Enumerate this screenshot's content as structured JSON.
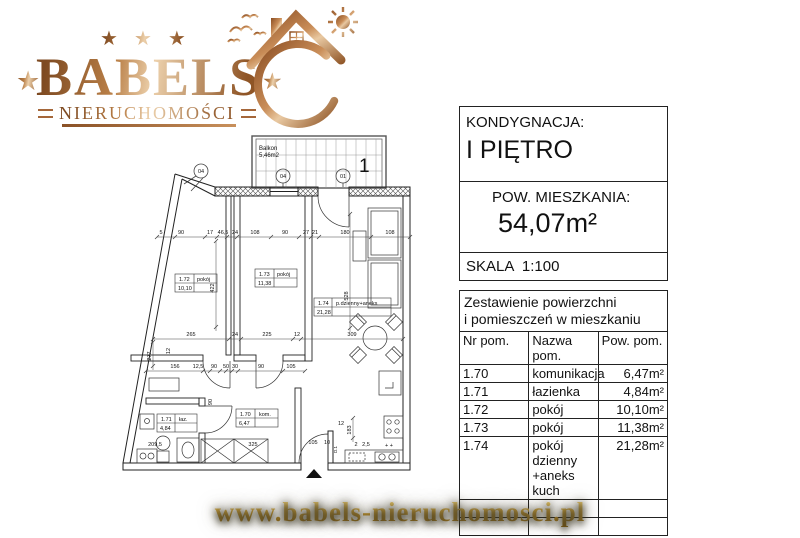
{
  "logo": {
    "brand": "BABELS",
    "subtitle": "NIERUCHOMOŚCI",
    "star": "★",
    "icon": "house-sun-birds-crescent"
  },
  "panel": {
    "floor_label": "KONDYGNACJA:",
    "floor_value": "I PIĘTRO",
    "area_label": "POW. MIESZKANIA:",
    "area_value": "54,07m²",
    "scale_label": "SKALA  1:100",
    "table": {
      "title_line1": "Zestawienie powierzchni",
      "title_line2": "i pomieszczeń w mieszkaniu",
      "headers": [
        "Nr pom.",
        "Nazwa pom.",
        "Pow. pom."
      ],
      "rows": [
        {
          "nr": "1.70",
          "name": "komunikacja",
          "area": "6,47m²"
        },
        {
          "nr": "1.71",
          "name": "łazienka",
          "area": "4,84m²"
        },
        {
          "nr": "1.72",
          "name": "pokój",
          "area": "10,10m²"
        },
        {
          "nr": "1.73",
          "name": "pokój",
          "area": "11,38m²"
        },
        {
          "nr": "1.74",
          "name": "pokój dzienny +aneks kuch",
          "area": "21,28m²"
        }
      ]
    }
  },
  "footer": {
    "url": "www.babels-nieruchomosci.pl"
  },
  "colors": {
    "copper": "#b97f47",
    "gold": "#d9a93c",
    "plan_line": "#222222"
  },
  "plan": {
    "balcony_name": "Balkon",
    "balcony_area": "5,46m2",
    "labels": [
      {
        "t": "Balkon",
        "x": 146,
        "y": 24,
        "s": 6
      },
      {
        "t": "5,46m2",
        "x": 146,
        "y": 31,
        "s": 6
      },
      {
        "t": "04",
        "x": 88,
        "y": 47,
        "s": 5.5,
        "a": "middle"
      },
      {
        "t": "04",
        "x": 170,
        "y": 52,
        "s": 5.5,
        "a": "middle"
      },
      {
        "t": "01",
        "x": 230,
        "y": 52,
        "s": 5.5,
        "a": "middle"
      },
      {
        "t": "1",
        "x": 246,
        "y": 46,
        "s": 19
      },
      {
        "t": "1.72",
        "x": 66,
        "y": 155
      },
      {
        "t": "pokój",
        "x": 84,
        "y": 155
      },
      {
        "t": "10,10",
        "x": 65,
        "y": 164
      },
      {
        "t": "1.73",
        "x": 146,
        "y": 150
      },
      {
        "t": "pokój",
        "x": 164,
        "y": 150
      },
      {
        "t": "11,38",
        "x": 145,
        "y": 159
      },
      {
        "t": "1.74",
        "x": 205,
        "y": 179
      },
      {
        "t": "p.dzienny+aneks",
        "x": 223,
        "y": 179
      },
      {
        "t": "21,28",
        "x": 204,
        "y": 188
      },
      {
        "t": "1.70",
        "x": 127,
        "y": 290
      },
      {
        "t": "kom.",
        "x": 146,
        "y": 290
      },
      {
        "t": "6,47",
        "x": 126,
        "y": 299
      },
      {
        "t": "1.71",
        "x": 48,
        "y": 295
      },
      {
        "t": "łaz.",
        "x": 66,
        "y": 295
      },
      {
        "t": "4,84",
        "x": 47,
        "y": 304
      },
      {
        "t": "5",
        "x": 48,
        "y": 108,
        "a": "middle"
      },
      {
        "t": "90",
        "x": 68,
        "y": 108,
        "a": "middle"
      },
      {
        "t": "17",
        "x": 97,
        "y": 108,
        "a": "middle"
      },
      {
        "t": "46,5",
        "x": 110,
        "y": 108,
        "a": "middle"
      },
      {
        "t": "24",
        "x": 122,
        "y": 108,
        "a": "middle"
      },
      {
        "t": "108",
        "x": 142,
        "y": 108,
        "a": "middle"
      },
      {
        "t": "90",
        "x": 172,
        "y": 108,
        "a": "middle"
      },
      {
        "t": "27",
        "x": 193,
        "y": 108,
        "a": "middle"
      },
      {
        "t": "21",
        "x": 202,
        "y": 108,
        "a": "middle"
      },
      {
        "t": "180",
        "x": 232,
        "y": 108,
        "a": "middle"
      },
      {
        "t": "108",
        "x": 277,
        "y": 108,
        "a": "middle"
      },
      {
        "t": "265",
        "x": 78,
        "y": 210,
        "a": "middle"
      },
      {
        "t": "24",
        "x": 122,
        "y": 210,
        "a": "middle"
      },
      {
        "t": "225",
        "x": 154,
        "y": 210,
        "a": "middle"
      },
      {
        "t": "12",
        "x": 184,
        "y": 210,
        "a": "middle"
      },
      {
        "t": "309",
        "x": 239,
        "y": 210,
        "a": "middle"
      },
      {
        "t": "156",
        "x": 62,
        "y": 242,
        "a": "middle"
      },
      {
        "t": "12,5",
        "x": 85,
        "y": 242,
        "a": "middle"
      },
      {
        "t": "90",
        "x": 101,
        "y": 242,
        "a": "middle"
      },
      {
        "t": "50",
        "x": 113,
        "y": 242,
        "a": "middle"
      },
      {
        "t": "30",
        "x": 122,
        "y": 242,
        "a": "middle"
      },
      {
        "t": "90",
        "x": 148,
        "y": 242,
        "a": "middle"
      },
      {
        "t": "105",
        "x": 178,
        "y": 242,
        "a": "middle"
      },
      {
        "t": "422",
        "x": 101,
        "y": 162,
        "r": -90,
        "a": "middle"
      },
      {
        "t": "528",
        "x": 235,
        "y": 170,
        "r": -90,
        "a": "middle"
      },
      {
        "t": "277",
        "x": 38,
        "y": 230,
        "r": -90,
        "a": "middle"
      },
      {
        "t": "183",
        "x": 238,
        "y": 304,
        "r": -90,
        "a": "middle"
      },
      {
        "t": "12",
        "x": 228,
        "y": 299,
        "a": "middle"
      },
      {
        "t": "12",
        "x": 57,
        "y": 225,
        "r": -90,
        "a": "middle"
      },
      {
        "t": "90",
        "x": 99,
        "y": 276,
        "r": -90,
        "a": "middle"
      },
      {
        "t": "209,5",
        "x": 42,
        "y": 320,
        "a": "middle"
      },
      {
        "t": "325",
        "x": 140,
        "y": 320,
        "a": "middle"
      },
      {
        "t": "105",
        "x": 200,
        "y": 318,
        "a": "middle"
      },
      {
        "t": "10",
        "x": 214,
        "y": 318,
        "a": "middle"
      },
      {
        "t": "2",
        "x": 243,
        "y": 320,
        "a": "middle"
      },
      {
        "t": "2,5",
        "x": 253,
        "y": 320,
        "a": "middle"
      },
      {
        "t": "+ +",
        "x": 272,
        "y": 321
      },
      {
        "t": "D.1",
        "x": 224,
        "y": 327,
        "r": -90,
        "s": 4.5
      }
    ]
  }
}
